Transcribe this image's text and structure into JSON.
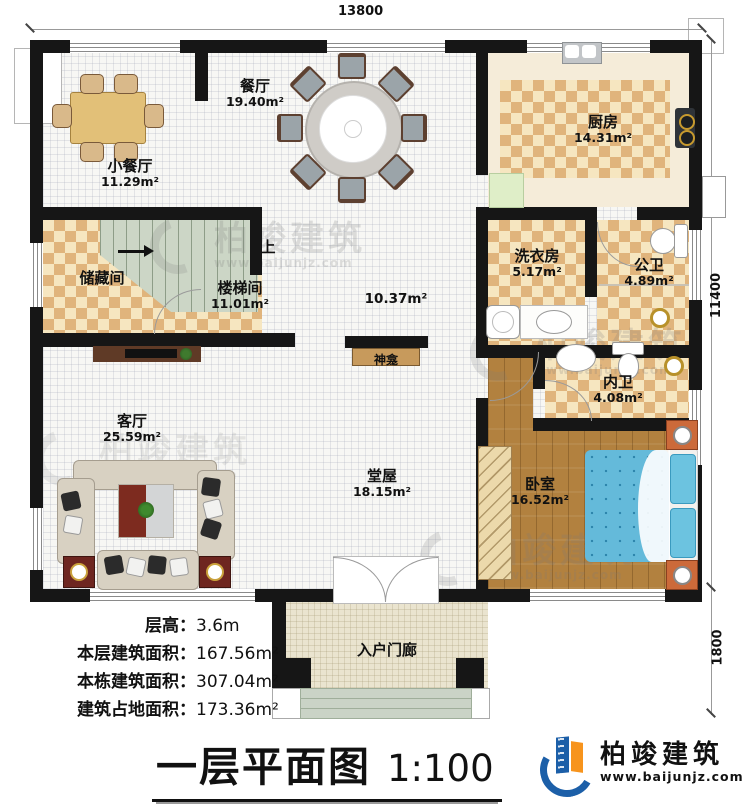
{
  "meta": {
    "title": "一层平面图",
    "scale": "1:100"
  },
  "dimensions": {
    "top": "13800",
    "right_upper": "11400",
    "right_lower": "1800"
  },
  "info": [
    {
      "label": "层高：",
      "value": "3.6m"
    },
    {
      "label": "本层建筑面积：",
      "value": "167.56m²"
    },
    {
      "label": "本栋建筑面积：",
      "value": "307.04m²"
    },
    {
      "label": "建筑占地面积：",
      "value": "173.36m²"
    }
  ],
  "rooms": [
    {
      "name": "小餐厅",
      "area": "11.29m²"
    },
    {
      "name": "餐厅",
      "area": "19.40m²"
    },
    {
      "name": "厨房",
      "area": "14.31m²"
    },
    {
      "name": "洗衣房",
      "area": "5.17m²"
    },
    {
      "name": "公卫",
      "area": "4.89m²"
    },
    {
      "name": "内卫",
      "area": "4.08m²"
    },
    {
      "name": "卧室",
      "area": "16.52m²"
    },
    {
      "name": "楼梯间",
      "area": "11.01m²"
    },
    {
      "name": "储藏间",
      "area": ""
    },
    {
      "name": "客厅",
      "area": "25.59m²"
    },
    {
      "name": "堂屋",
      "area": "18.15m²"
    },
    {
      "name": "入户门廊",
      "area": ""
    },
    {
      "name": "",
      "area": "10.37m²"
    }
  ],
  "labels": {
    "stairs_up": "上",
    "shrine": "神龛"
  },
  "logo": {
    "name": "柏竣建筑",
    "url": "www.baijunjz.com"
  },
  "watermark": {
    "name": "柏竣建筑",
    "url": "www.baijunjz.com"
  },
  "colors": {
    "wall": "#161616",
    "checker_dark": "#e0b47c",
    "checker_light": "#f6e6c0",
    "wood": "#b2813f",
    "stair": "#ccd6c6",
    "mattress": "#64bada",
    "logo_blue": "#1c5fa8",
    "logo_orange": "#f7941d"
  }
}
